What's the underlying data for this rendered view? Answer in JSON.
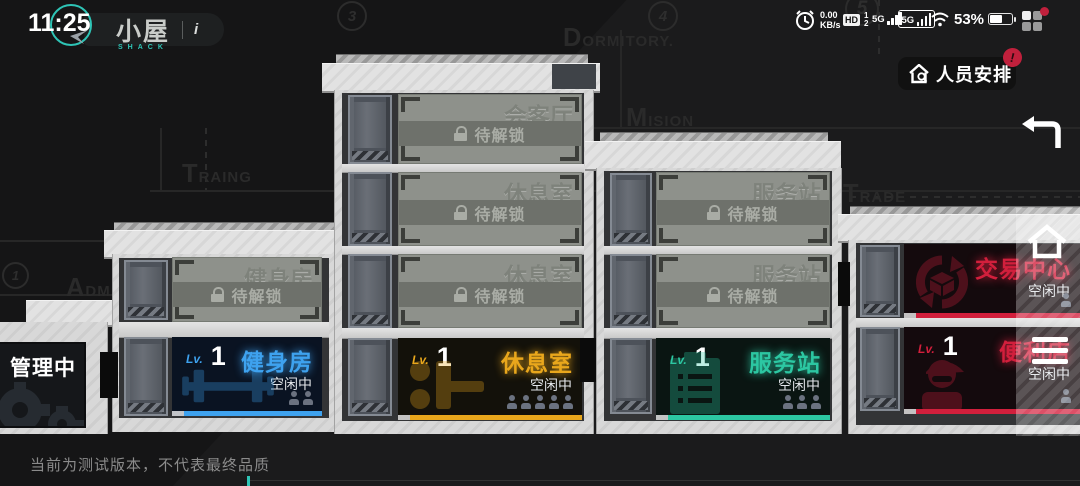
{
  "status_bar": {
    "time": "11:25",
    "net_speed": "0.00",
    "net_unit": "KB/s",
    "hd": "HD",
    "sim1": "1",
    "sim2": "2",
    "signal1": "5G",
    "signal2": "5G",
    "battery": "53%"
  },
  "header": {
    "title": "小屋",
    "subtitle": "SHACK",
    "info": "i"
  },
  "toolbar": {
    "personnel": "人员安排",
    "personnel_badge": "!"
  },
  "blueprint": {
    "m1": "1",
    "m3": "3",
    "m4": "4",
    "m5": "5",
    "dormitory": "Dormitory.",
    "mision": "Mision",
    "traing": "Traing",
    "trade": "Trade",
    "adm": "Adm"
  },
  "rooms": {
    "admin": {
      "name": "管理中心"
    },
    "gym_locked": {
      "ghost": "健身房",
      "status": "待解锁"
    },
    "gym": {
      "lv_label": "Lv.",
      "lv": "1",
      "name": "健身房",
      "status": "空闲中",
      "people": 2
    },
    "meeting_locked": {
      "ghost": "会客厅",
      "status": "待解锁"
    },
    "lounge_locked_a": {
      "ghost": "休息室",
      "status": "待解锁"
    },
    "lounge_locked_b": {
      "ghost": "休息室",
      "status": "待解锁"
    },
    "lounge": {
      "lv_label": "Lv.",
      "lv": "1",
      "name": "休息室",
      "status": "空闲中",
      "people": 5
    },
    "service_locked_a": {
      "ghost": "服务站",
      "status": "待解锁"
    },
    "service_locked_b": {
      "ghost": "服务站",
      "status": "待解锁"
    },
    "service": {
      "lv_label": "Lv.",
      "lv": "1",
      "name": "服务站",
      "status": "空闲中",
      "people": 3
    },
    "trade": {
      "name": "交易中心",
      "status": "空闲中",
      "people": 1
    },
    "store": {
      "lv_label": "Lv.",
      "lv": "1",
      "name": "便利店",
      "status": "空闲中",
      "people": 1
    }
  },
  "colors": {
    "gym": "#3ea2ef",
    "lounge": "#e9a71c",
    "service": "#2cc7a2",
    "trade": "#d21f3c",
    "teal": "#2ec4b6",
    "badge": "#c0203c"
  },
  "footer": {
    "disclaimer": "当前为测试版本，不代表最终品质"
  }
}
